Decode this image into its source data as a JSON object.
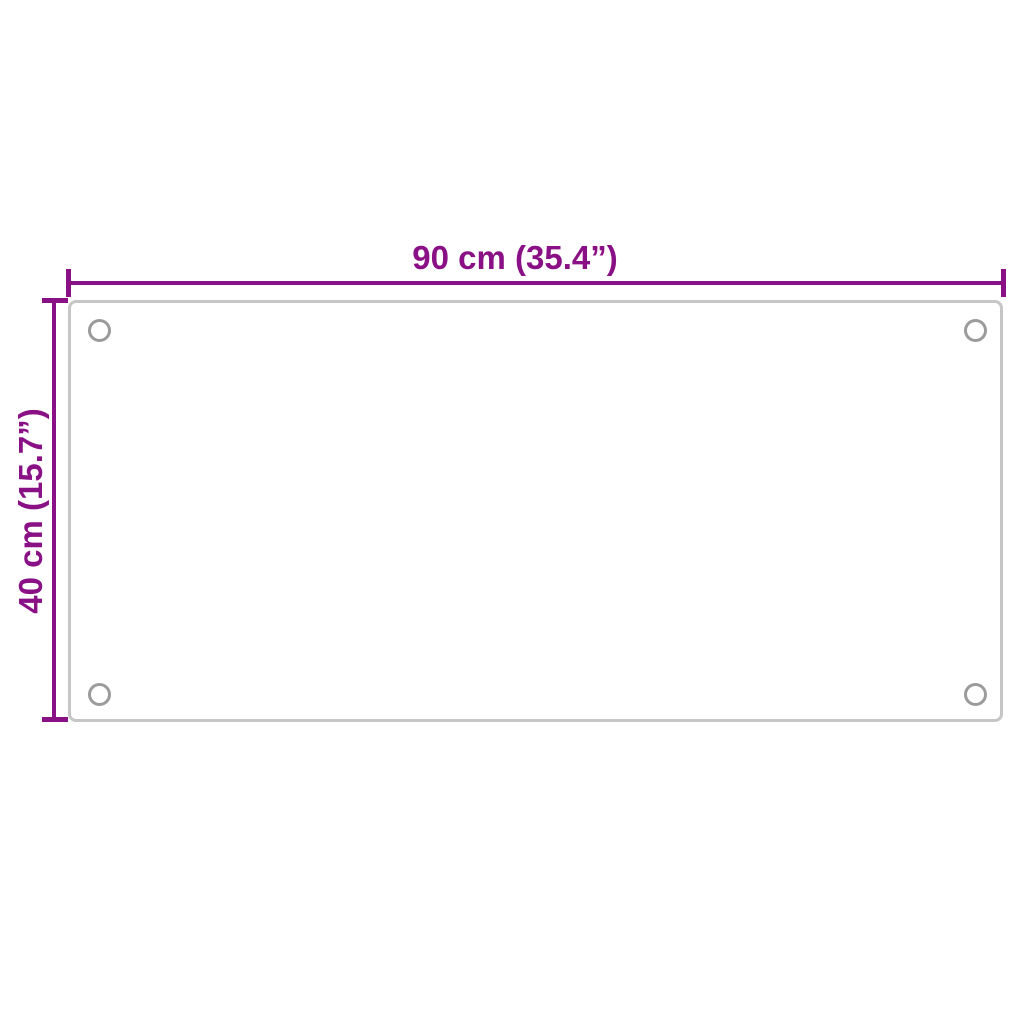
{
  "diagram": {
    "type": "product-dimension-diagram",
    "subject": "rectangular panel with four corner mounting holes",
    "width_label": "90 cm (35.4”)",
    "height_label": "40 cm (15.7”)",
    "holes_count": 4,
    "colors": {
      "dimension_accent": "#8A1085",
      "panel_border": "#C6C6C6",
      "hole_stroke": "#9B9B9B",
      "background": "#FFFFFF"
    }
  }
}
